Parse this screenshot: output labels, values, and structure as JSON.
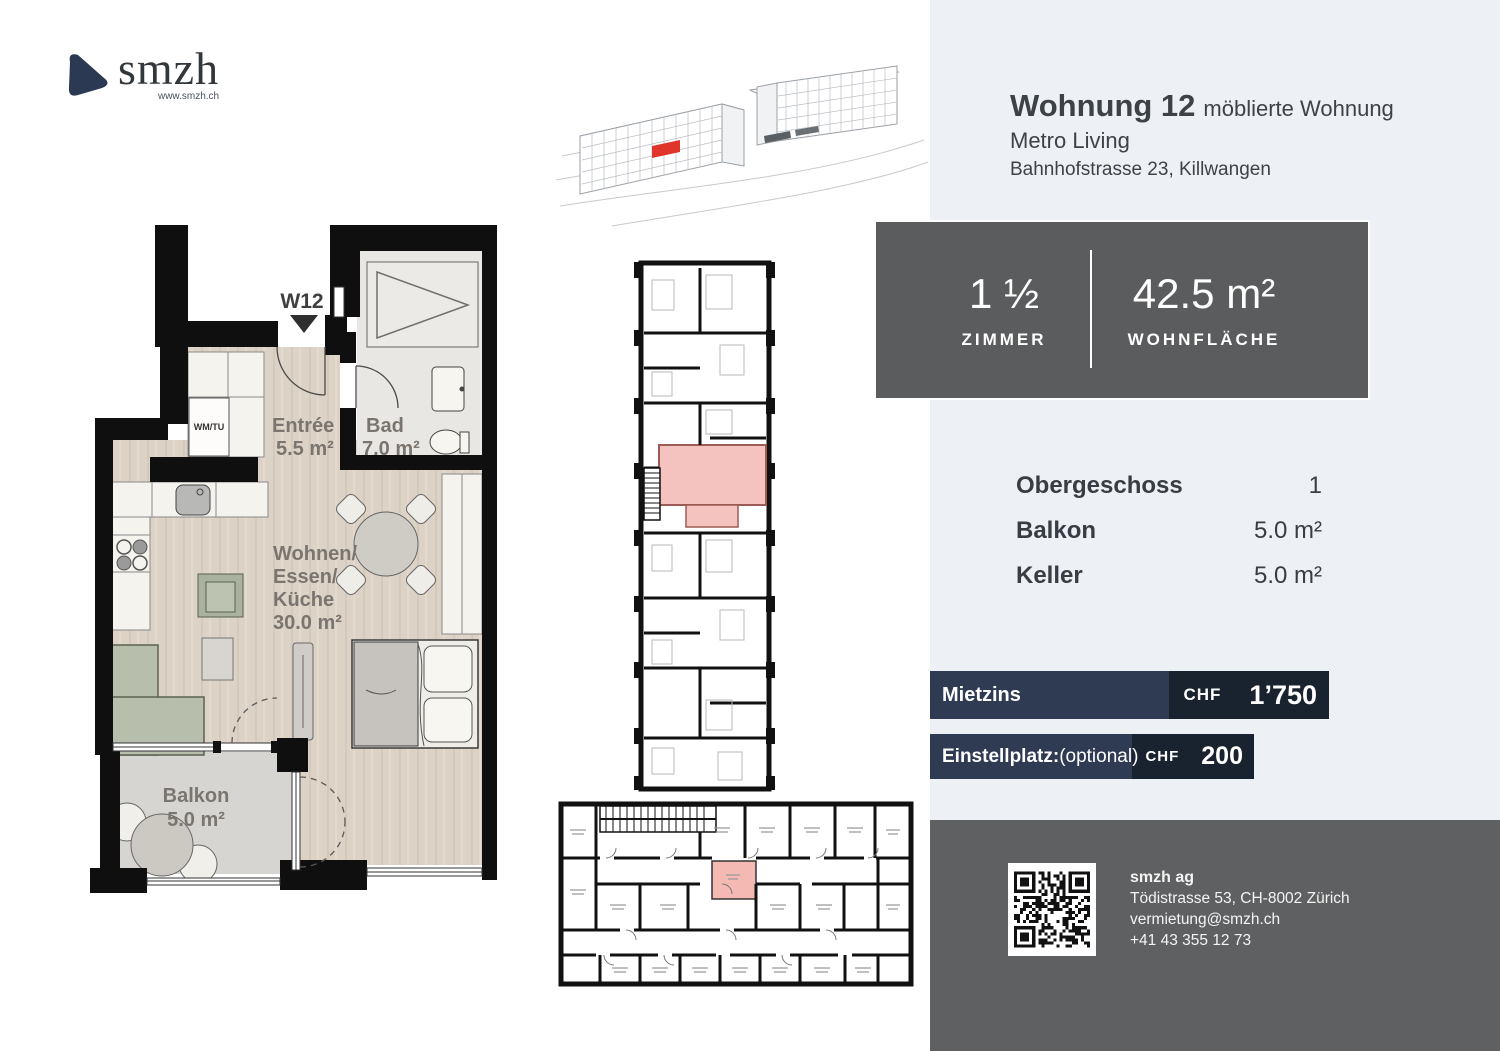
{
  "logo": {
    "name": "smzh",
    "url": "www.smzh.ch",
    "icon_color": "#2b3a52"
  },
  "header": {
    "title": "Wohnung 12",
    "subtitle": "möblierte Wohnung",
    "project": "Metro Living",
    "address": "Bahnhofstrasse 23, Killwangen"
  },
  "info_box": {
    "rooms_value": "1 ½",
    "rooms_label": "ZIMMER",
    "area_value": "42.5 m²",
    "area_label": "WOHNFLÄCHE"
  },
  "details": [
    {
      "label": "Obergeschoss",
      "value": "1"
    },
    {
      "label": "Balkon",
      "value": "5.0 m²"
    },
    {
      "label": "Keller",
      "value": "5.0 m²"
    }
  ],
  "pricing": [
    {
      "label": "Mietzins",
      "suffix": "",
      "currency": "CHF",
      "amount": "1’750"
    },
    {
      "label": "Einstellplatz:",
      "suffix": "(optional)",
      "currency": "CHF",
      "amount": "200"
    }
  ],
  "footer": {
    "company": "smzh ag",
    "address": "Tödistrasse 53, CH-8002 Zürich",
    "email": "vermietung@smzh.ch",
    "phone": "+41 43 355 12 73"
  },
  "floorplan": {
    "unit_marker": "W12",
    "rooms": {
      "entree": {
        "name": "Entrée",
        "area": "5.5 m²"
      },
      "bad": {
        "name": "Bad",
        "area": "7.0 m²"
      },
      "wohnen": {
        "line1": "Wohnen/",
        "line2": "Essen/",
        "line3": "Küche",
        "area": "30.0 m²"
      },
      "balkon": {
        "name": "Balkon",
        "area": "5.0 m²"
      },
      "wm": "WM/TU"
    }
  },
  "colors": {
    "panel_bg": "#edf0f4",
    "info_box_bg": "#5b5c5d",
    "bar_dark": "#19222f",
    "bar_light": "#2e3b53",
    "footer_bg": "#5f6061",
    "highlight_pink": "#f5c3bf",
    "highlight_red": "#e0352b",
    "floor_beige": "#dcd2c5",
    "balcony_gray": "#d6d5d2"
  }
}
